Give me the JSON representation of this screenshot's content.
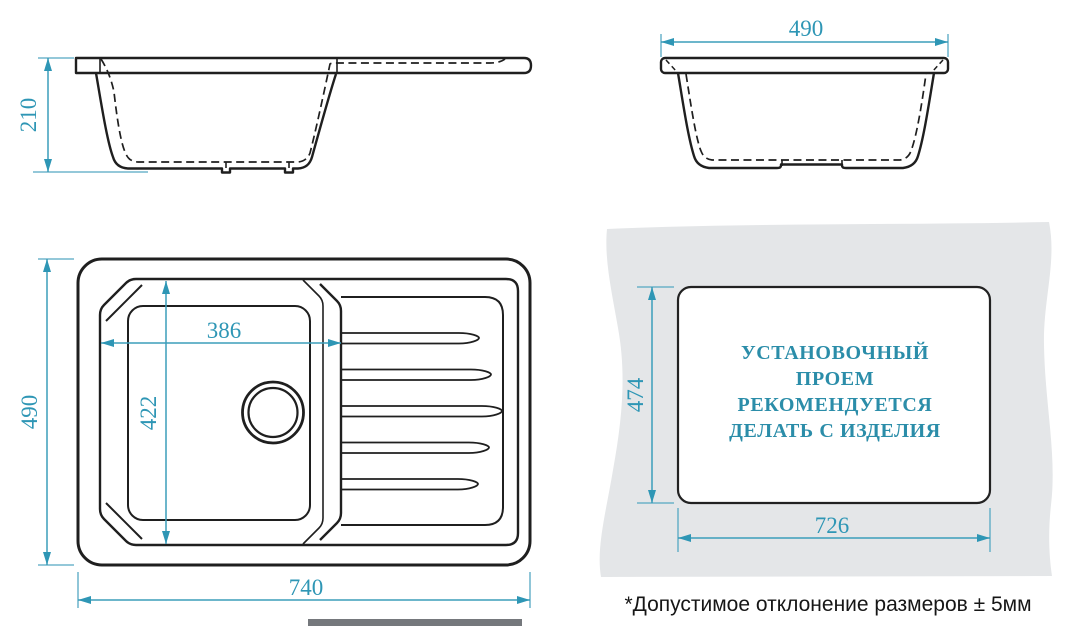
{
  "diagram": {
    "side_view": {
      "height_label": "210"
    },
    "front_view": {
      "width_label": "490"
    },
    "top_view": {
      "depth_label": "490",
      "length_label": "740",
      "bowl_width_label": "386",
      "bowl_depth_label": "422"
    },
    "cutout_view": {
      "height_label": "474",
      "width_label": "726",
      "note_lines": [
        "УСТАНОВОЧНЫЙ",
        "ПРОЕМ",
        "РЕКОМЕНДУЕТСЯ",
        "ДЕЛАТЬ С ИЗДЕЛИЯ"
      ]
    },
    "footnote": "*Допустимое отклонение размеров ± 5мм"
  },
  "colors": {
    "drawing_line": "#1f1f1f",
    "dimension_text": "#2e96b5",
    "dimension_line": "#55a8c2",
    "note_text": "#2b8da9",
    "countertop_gray": "#e4e6e8",
    "footnote_text": "#161616"
  }
}
